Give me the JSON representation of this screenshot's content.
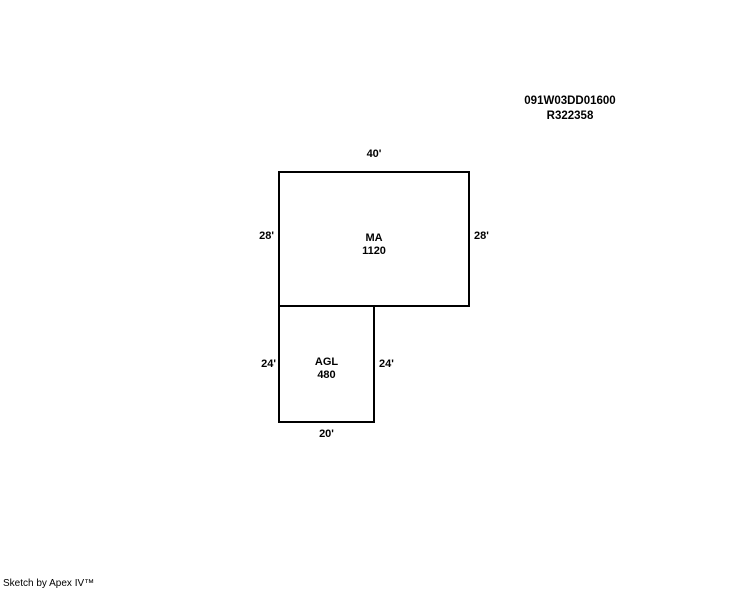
{
  "colors": {
    "ink": "#000000",
    "background": "#ffffff"
  },
  "header": {
    "parcel_id": "091W03DD01600",
    "account_number": "R322358"
  },
  "sketch": {
    "ma": {
      "code": "MA",
      "area": "1120",
      "top_dim": "40'",
      "left_dim": "28'",
      "right_dim": "28'"
    },
    "agl": {
      "code": "AGL",
      "area": "480",
      "left_dim": "24'",
      "right_dim": "24'",
      "bottom_dim": "20'"
    }
  },
  "footer": {
    "credit": "Sketch by Apex IV™"
  }
}
